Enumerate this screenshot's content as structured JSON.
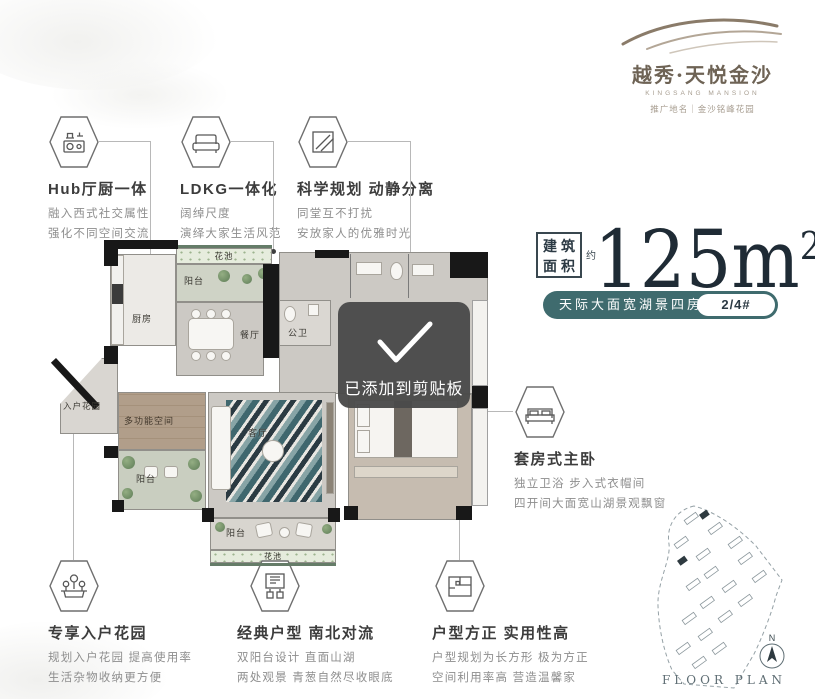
{
  "logo": {
    "brand": "越秀·天悦金沙",
    "brand_en": "KINGSANG MANSION",
    "subtitle": "推广地名｜金沙铭峰花园"
  },
  "area": {
    "label_line1": "建筑",
    "label_line2": "面积",
    "approx": "约",
    "value": "125",
    "unit": "m",
    "unit_sup": "2"
  },
  "tagline": {
    "text": "天际大面宽湖景四房",
    "badge": "2/4#"
  },
  "toast": {
    "message": "已添加到剪贴板"
  },
  "features_top": [
    {
      "title": "Hub厅厨一体",
      "line1": "融入西式社交属性",
      "line2": "强化不同空间交流"
    },
    {
      "title": "LDKG一体化",
      "line1": "阔绰尺度",
      "line2": "演绎大家生活风范"
    },
    {
      "title": "科学规划 动静分离",
      "line1": "同堂互不打扰",
      "line2": "安放家人的优雅时光"
    }
  ],
  "feature_right": {
    "title": "套房式主卧",
    "line1": "独立卫浴 步入式衣帽间",
    "line2": "四开间大面宽山湖景观飘窗"
  },
  "features_bottom": [
    {
      "title": "专享入户花园",
      "line1": "规划入户花园 提高使用率",
      "line2": "生活杂物收纳更方便"
    },
    {
      "title": "经典户型 南北对流",
      "line1": "双阳台设计 直面山湖",
      "line2": "两处观景 青葱自然尽收眼底"
    },
    {
      "title": "户型方正 实用性高",
      "line1": "户型规划为长方形 极为方正",
      "line2": "空间利用率高 营造温馨家"
    }
  ],
  "floorplan": {
    "flower_bed_top": "花池",
    "balcony_top": "阳台",
    "kitchen": "厨房",
    "dining": "餐厅",
    "guest_bath": "公卫",
    "entry_garden": "入户花园",
    "multi_room": "多功能空间",
    "living": "客厅",
    "balcony_left": "阳台",
    "balcony_bottom": "阳台",
    "flower_bed_bottom": "花池"
  },
  "siteplan": {
    "title": "FLOOR PLAN",
    "compass": "N"
  },
  "colors": {
    "teal": "#3f6b6e",
    "ink": "#1f2b35",
    "toast_bg": "#4a4a4a"
  }
}
